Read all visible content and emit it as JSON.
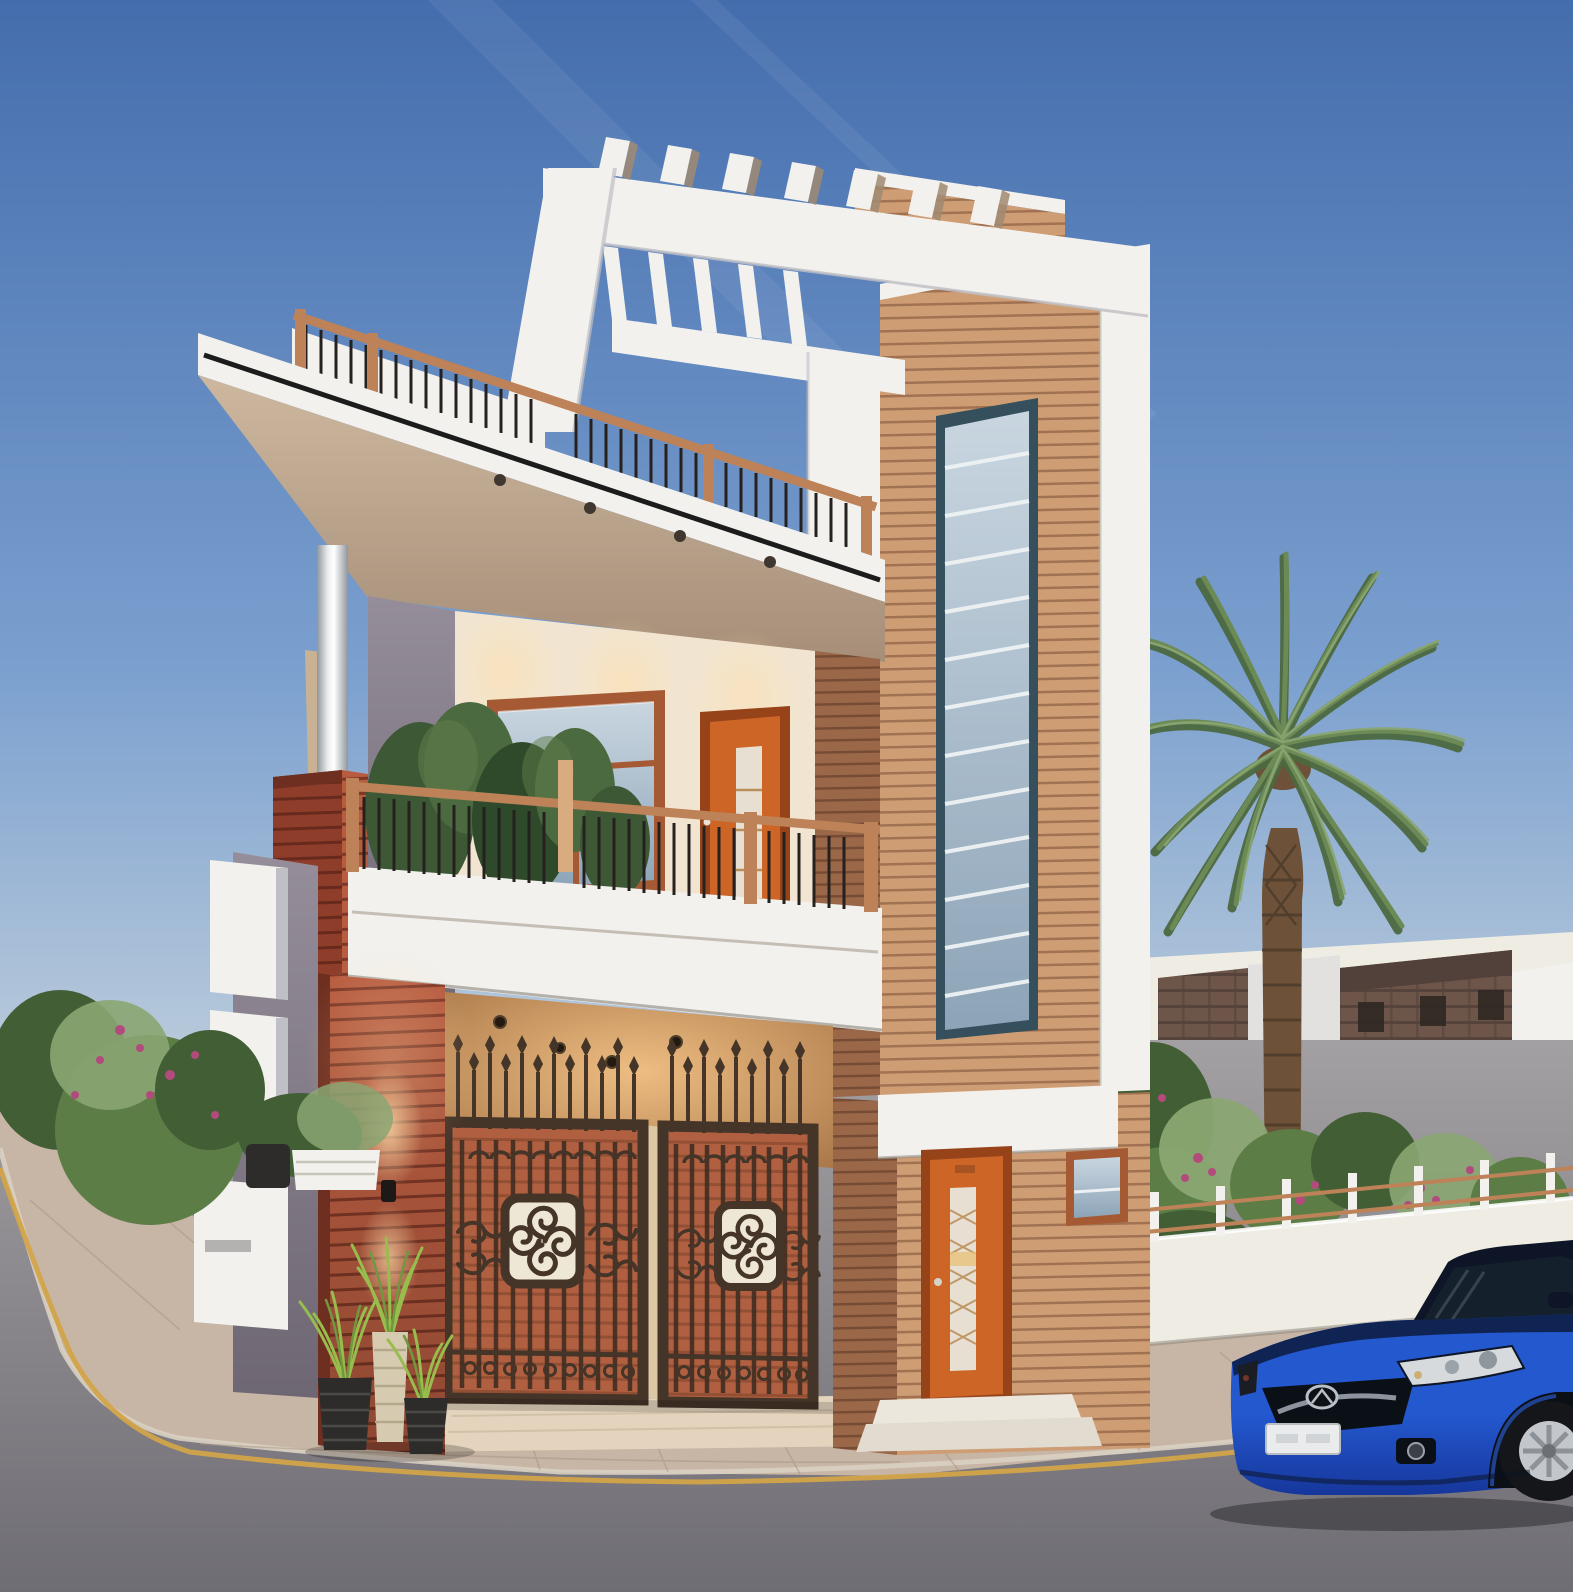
{
  "meta": {
    "description": "Dusk 3D architectural render: modern three-storey corner house with white concrete frames and pergola, wood slat cladding, iron entrance gates, balcony, palm tree, neighbouring brick houses, paved sidewalk, asphalt road with yellow curb line and a blue sedan parked at the right."
  },
  "palette": {
    "sky_top": "#446dad",
    "sky_mid": "#7ba0cf",
    "sky_low": "#c7d4de",
    "sky_horizon": "#f2ead7",
    "white": "#f2f1ee",
    "white_dim": "#e2e1e0",
    "white_dark": "#bfc0c5",
    "soffit": "#cdb89f",
    "soffit_dark": "#a68e78",
    "cream": "#f1e5d1",
    "glow": "#ffdfae",
    "wood_light": "#cf9d74",
    "wood_mid": "#c48e64",
    "wood_gap": "#7c4e36",
    "wood_side": "#9a6848",
    "wood_side_dark": "#6f4530",
    "red": "#b85c40",
    "red_deep": "#8d3d2a",
    "red_dark": "#6e2f20",
    "red_gap": "#5e2418",
    "gray_wall": "#958e9a",
    "gray_wall_dark": "#6e6773",
    "steel_light": "#eceeee",
    "steel_dark": "#8f969b",
    "frame_brown": "#a55a33",
    "glass_light": "#c9d6e0",
    "glass_dark": "#8da4b8",
    "tower_frame": "#35505c",
    "bar_white": "#eef2f4",
    "door_orange": "#cd6527",
    "door_deep": "#97431a",
    "door_glass": "#e7e0d2",
    "rail_wood": "#bd8258",
    "baluster": "#26211e",
    "gate_frame": "#453428",
    "gate_fill": "#b06040",
    "gate_line": "#6e3a26",
    "medallion": "#efe7d5",
    "pillar": "#dcc8a4",
    "porch_glow": "#eebd82",
    "porch_deep": "#a97748",
    "brick": "#6d5549",
    "brick_dark": "#52403a",
    "planter_tan": "#d7c096",
    "wall_white": "#efece3",
    "palm_green": "#6c8a55",
    "palm_green_dark": "#4c6940",
    "palm_green_light": "#8aa672",
    "palm_trunk": "#6d5239",
    "palm_trunk_dark": "#4c3a2a",
    "shrub": "#5d7d47",
    "shrub_dark": "#415e35",
    "flower": "#b34a7d",
    "pot_dark": "#2d2c2a",
    "pot_weave": "#4c4a47",
    "pot_cream": "#d6cab0",
    "grass": "#97bd4d",
    "grass_dark": "#6f9840",
    "sidewalk": "#c7b5a5",
    "paver": "#a8937f",
    "walkway": "#e4d4bd",
    "curb": "#d9d0c3",
    "road": "#a3a0a3",
    "road_dark": "#6f6d74",
    "yellow": "#d2a449",
    "car_blue": "#2458cf",
    "car_blue_dark": "#16379c",
    "car_hood_dark": "#0c1b3d",
    "car_black": "#0b0f16",
    "car_glass": "#15202d",
    "car_silver": "#d6dadd",
    "plate": "#e9ebed",
    "rim": "#c3c7cc"
  },
  "scene": {
    "time_of_day": "dusk",
    "objects": [
      "sky",
      "contrail-streaks",
      "neighbour-brick-house",
      "main-house",
      "pergola-roof-frame",
      "wood-slat-tower",
      "roof-terrace-railing",
      "chimney-pipe",
      "balcony",
      "balcony-plants",
      "entrance-gates",
      "wall-sconce",
      "entry-doors",
      "compound-wall",
      "garden-fence",
      "palm-tree",
      "flowering-shrubs",
      "plant-pots",
      "sidewalk",
      "road",
      "yellow-curb-line",
      "blue-sedan"
    ],
    "house": {
      "storeys": 3,
      "cladding": [
        "white concrete",
        "wood slats",
        "red slats"
      ],
      "lights_on": true
    },
    "car": {
      "type": "sedan",
      "brand_mark": "mazda-wing-emblem",
      "color_key": "car_blue"
    }
  }
}
